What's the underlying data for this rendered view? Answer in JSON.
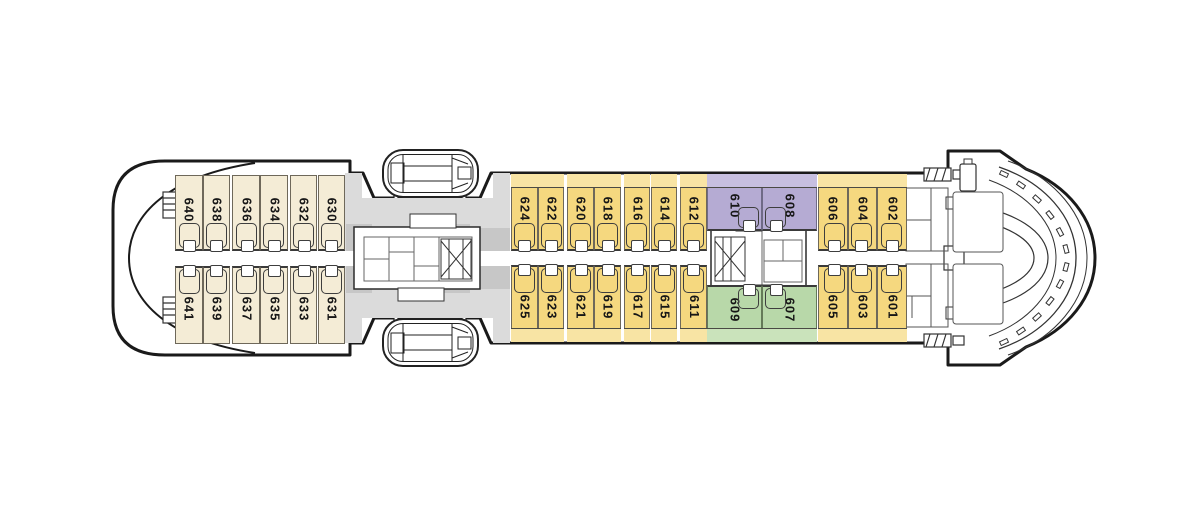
{
  "colors": {
    "cream": "#F4ECD6",
    "yellow": "#F5D87F",
    "yellowStrip": "#F8E4A4",
    "purple": "#B5ABD3",
    "purpleStrip": "#C7BFE0",
    "green": "#B8D8A9",
    "greenStrip": "#CAE3BB",
    "gray": "#DBDBDB",
    "grayDark": "#C7C7C7",
    "outline": "#1A1A1A"
  },
  "sections": {
    "stern": {
      "top": [
        "640",
        "638",
        "636",
        "634",
        "632",
        "630"
      ],
      "bottom": [
        "641",
        "639",
        "637",
        "635",
        "633",
        "631"
      ]
    },
    "midship": {
      "top": [
        "624",
        "622",
        "620",
        "618",
        "616",
        "614",
        "612"
      ],
      "bottom": [
        "625",
        "623",
        "621",
        "619",
        "617",
        "615",
        "611"
      ]
    },
    "suites": {
      "top": [
        "610",
        "608"
      ],
      "bottom": [
        "609",
        "607"
      ]
    },
    "forward": {
      "top": [
        "606",
        "604",
        "602"
      ],
      "bottom": [
        "605",
        "603",
        "601"
      ]
    }
  },
  "icons": {
    "bed": "bed-icon",
    "lifeboat": "lifeboat-icon",
    "stairs": "stairs-icon",
    "ladder_hatch": "ladder-hatch-icon"
  }
}
